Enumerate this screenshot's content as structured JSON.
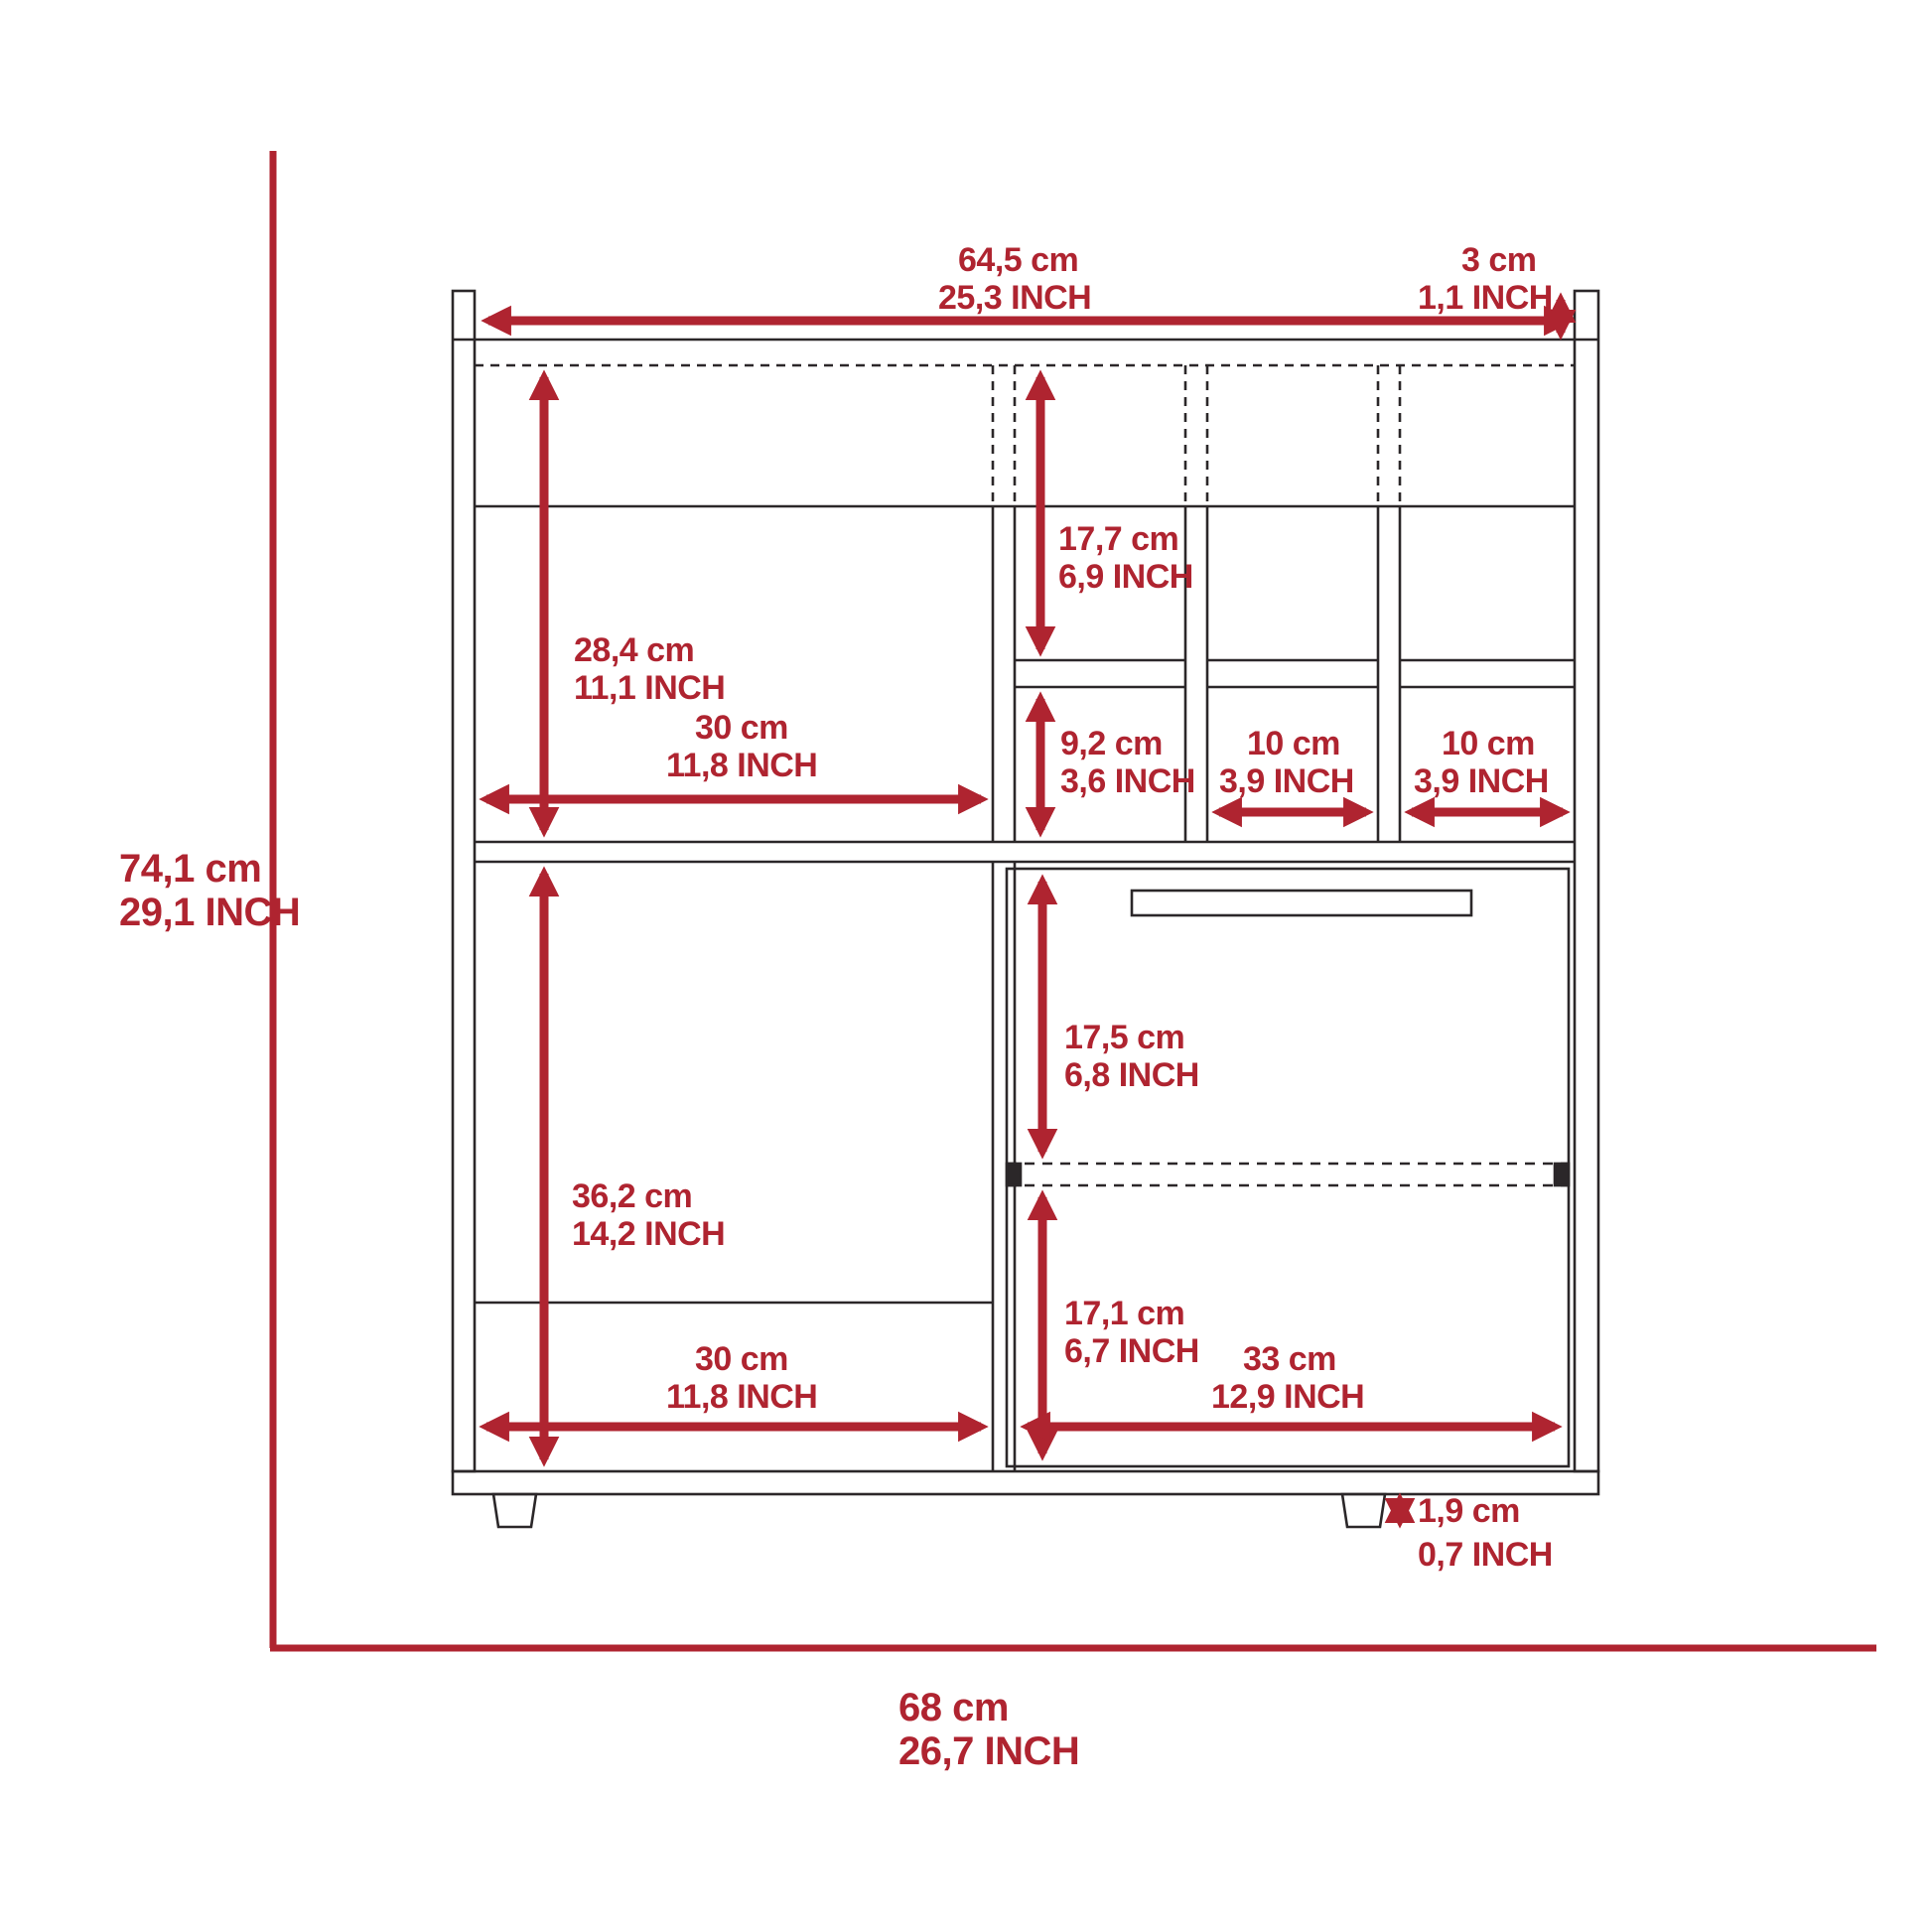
{
  "figure": {
    "type": "furniture-dimension-diagram",
    "units": [
      "cm",
      "INCH"
    ]
  },
  "colors": {
    "dimension_red": "#AF2430",
    "line_dark": "#2B2729",
    "background": "#FFFFFF"
  },
  "dimensions": {
    "top_width": {
      "cm": "64,5 cm",
      "inch": "25,3 INCH"
    },
    "top_thickness": {
      "cm": "3 cm",
      "inch": "1,1 INCH"
    },
    "cubby_top_height": {
      "cm": "17,7 cm",
      "inch": "6,9 INCH"
    },
    "left_top_height": {
      "cm": "28,4 cm",
      "inch": "11,1 INCH"
    },
    "left_top_width": {
      "cm": "30 cm",
      "inch": "11,8 INCH"
    },
    "cubby_bottom_height": {
      "cm": "9,2 cm",
      "inch": "3,6 INCH"
    },
    "cubby_mid_width": {
      "cm": "10 cm",
      "inch": "3,9 INCH"
    },
    "cubby_right_width": {
      "cm": "10 cm",
      "inch": "3,9 INCH"
    },
    "overall_height": {
      "cm": "74,1 cm",
      "inch": "29,1 INCH"
    },
    "door_top_height": {
      "cm": "17,5 cm",
      "inch": "6,8 INCH"
    },
    "left_bottom_height": {
      "cm": "36,2 cm",
      "inch": "14,2 INCH"
    },
    "door_bottom_height": {
      "cm": "17,1 cm",
      "inch": "6,7 INCH"
    },
    "left_bottom_width": {
      "cm": "30 cm",
      "inch": "11,8 INCH"
    },
    "door_width": {
      "cm": "33 cm",
      "inch": "12,9 INCH"
    },
    "foot_height": {
      "cm": "1,9 cm",
      "inch": "0,7 INCH"
    },
    "overall_width": {
      "cm": "68 cm",
      "inch": "26,7 INCH"
    }
  }
}
